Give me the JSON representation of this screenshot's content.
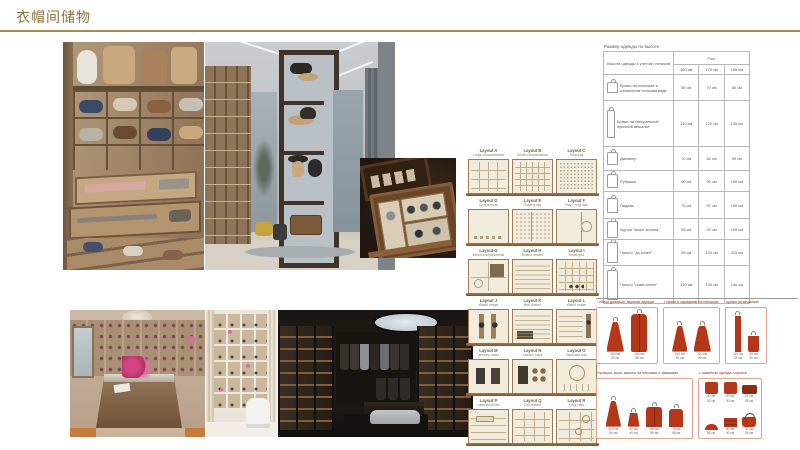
{
  "slide": {
    "title": "衣帽间储物"
  },
  "colors": {
    "accent_gold": "#a8894e",
    "garment_red": "#b5371a",
    "box_border_salmon": "#e2a48f",
    "header_red": "#8a2a15",
    "module_wood": "#a07a56"
  },
  "layouts": {
    "items": [
      {
        "label": "Layout A",
        "subtitle": "Large compartments",
        "pattern": "p-grid-lg"
      },
      {
        "label": "Layout B",
        "subtitle": "Small compartments",
        "pattern": "p-grid-sm"
      },
      {
        "label": "Layout C",
        "subtitle": "Ring tray",
        "pattern": "p-dots"
      },
      {
        "label": "Layout D",
        "subtitle": "Covered tray",
        "pattern": "p-open"
      },
      {
        "label": "Layout E",
        "subtitle": "Divided tray",
        "pattern": "p-split"
      },
      {
        "label": "Layout F",
        "subtitle": "Tray + ring dish",
        "pattern": "p-ring-side"
      },
      {
        "label": "Layout G",
        "subtitle": "Mixed compartments",
        "pattern": "p-quad"
      },
      {
        "label": "Layout H",
        "subtitle": "Slotted drawer",
        "pattern": "p-slats"
      },
      {
        "label": "Layout I",
        "subtitle": "Small grid",
        "pattern": "p-grid-marks"
      },
      {
        "label": "Layout J",
        "subtitle": "Watch straps",
        "pattern": "p-straps"
      },
      {
        "label": "Layout K",
        "subtitle": "Belt drawer",
        "pattern": "p-slats-stack"
      },
      {
        "label": "Layout L",
        "subtitle": "Watch holder",
        "pattern": "p-slats-strap"
      },
      {
        "label": "Layout M",
        "subtitle": "Jewelry cases",
        "pattern": "p-cases"
      },
      {
        "label": "Layout N",
        "subtitle": "Leather trays",
        "pattern": "p-case-circles"
      },
      {
        "label": "Layout O",
        "subtitle": "Necklace tray",
        "pattern": "p-necklace"
      },
      {
        "label": "Layout P",
        "subtitle": "Labeled boxes",
        "pattern": "p-rows-labels"
      },
      {
        "label": "Layout Q",
        "subtitle": "Cell drawer",
        "pattern": "p-cells"
      },
      {
        "label": "Layout R",
        "subtitle": "Ring cells",
        "pattern": "p-cells-rings"
      }
    ]
  },
  "size_table": {
    "title": "Размер одежды по высоте",
    "row_header": "Высота одежды с учетом плечиков",
    "col_group": "Рост",
    "columns": [
      "160 см",
      "170 см",
      "180 см"
    ],
    "rows": [
      {
        "icon": "gi-pants-folded",
        "item": "Брюки на плечиках в сложенном пополам виде",
        "values": [
          "65 см",
          "70 см",
          "80 см"
        ]
      },
      {
        "icon": "gi-pants-long",
        "item": "Брюки на специальной брючной вешалке",
        "values": [
          "110 см",
          "120 см",
          "135 см"
        ]
      },
      {
        "icon": "gi-sweater",
        "item": "Джемпер",
        "values": [
          "70 см",
          "80 см",
          "90 см"
        ]
      },
      {
        "icon": "gi-shirt",
        "item": "Рубашка",
        "values": [
          "80 см",
          "90 см",
          "100 см"
        ]
      },
      {
        "icon": "gi-jacket",
        "item": "Пиджак",
        "values": [
          "75 см",
          "87 см",
          "100 см"
        ]
      },
      {
        "icon": "gi-coat-short",
        "item": "Куртка \"выше колена\"",
        "values": [
          "85 см",
          "92 см",
          "105 см"
        ]
      },
      {
        "icon": "gi-coat",
        "item": "Пальто \"до колен\"",
        "values": [
          "95 см",
          "103 см",
          "115 см"
        ]
      },
      {
        "icon": "gi-coat-long",
        "item": "Пальто \"ниже колен\"",
        "values": [
          "120 см",
          "130 см",
          "140 см"
        ]
      }
    ]
  },
  "garment_boxes": {
    "boxes": [
      {
        "title": "Платья длинные, верхняя одежда",
        "items": [
          {
            "shape": "s-dress",
            "h": "140 см",
            "w": "50 см"
          },
          {
            "shape": "s-coat",
            "h": "160 см",
            "w": "55 см"
          }
        ]
      },
      {
        "title": "Платья и сарафаны на плечиках",
        "items": [
          {
            "shape": "s-dress-sm",
            "h": "110 см",
            "w": "50 см"
          },
          {
            "shape": "s-dress-sm2",
            "h": "110 см",
            "w": "55 см"
          }
        ]
      },
      {
        "title": "Брюки на вешалках",
        "items": [
          {
            "shape": "s-pants",
            "h": "110 см",
            "w": "25 см"
          },
          {
            "shape": "s-pants-folded",
            "h": "65 см",
            "w": "30 см"
          }
        ]
      },
      {
        "title": "Рубашки, юбки, жакеты на плечиках с зажимами",
        "items": [
          {
            "shape": "s-dress-sm",
            "h": "110 см",
            "w": "50 см"
          },
          {
            "shape": "s-skirt",
            "h": "60 см",
            "w": "40 см"
          },
          {
            "shape": "s-shirt",
            "h": "80 см",
            "w": "55 см"
          },
          {
            "shape": "s-jacket",
            "h": "75 см",
            "w": "55 см"
          }
        ]
      },
      {
        "title": "Сложенная одежда, коробки",
        "items": [
          {
            "shape": "s-folded",
            "h": "40 см",
            "w": "30 см"
          },
          {
            "shape": "s-folded",
            "h": "40 см",
            "w": "30 см"
          },
          {
            "shape": "s-case",
            "h": "25 см",
            "w": "35 см"
          },
          {
            "shape": "s-cap",
            "h": "",
            "w": "55 см"
          },
          {
            "shape": "s-stack",
            "h": "30 см",
            "w": "40 см"
          },
          {
            "shape": "s-bag",
            "h": "30 см",
            "w": "35 см"
          }
        ]
      }
    ]
  }
}
